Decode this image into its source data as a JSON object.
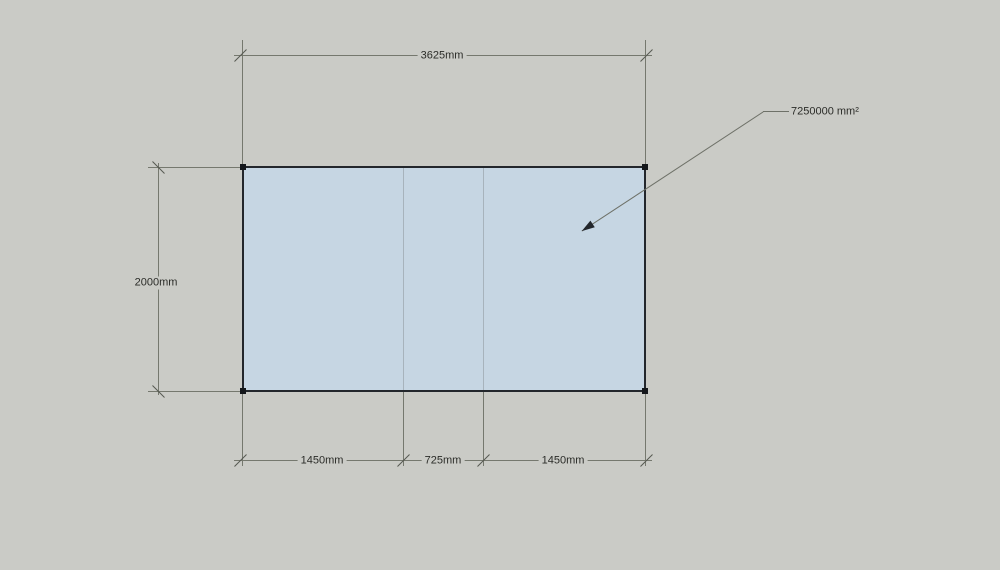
{
  "viewport": {
    "background_color": "#cacbc6"
  },
  "face": {
    "fill_color": "#c6d6e3",
    "edge_color": "#23272c"
  },
  "dimensions": {
    "top": {
      "label": "3625mm"
    },
    "left": {
      "label": "2000mm"
    },
    "bottom": [
      {
        "label": "1450mm"
      },
      {
        "label": "725mm"
      },
      {
        "label": "1450mm"
      }
    ]
  },
  "annotation": {
    "area_label": "7250000 mm²"
  }
}
